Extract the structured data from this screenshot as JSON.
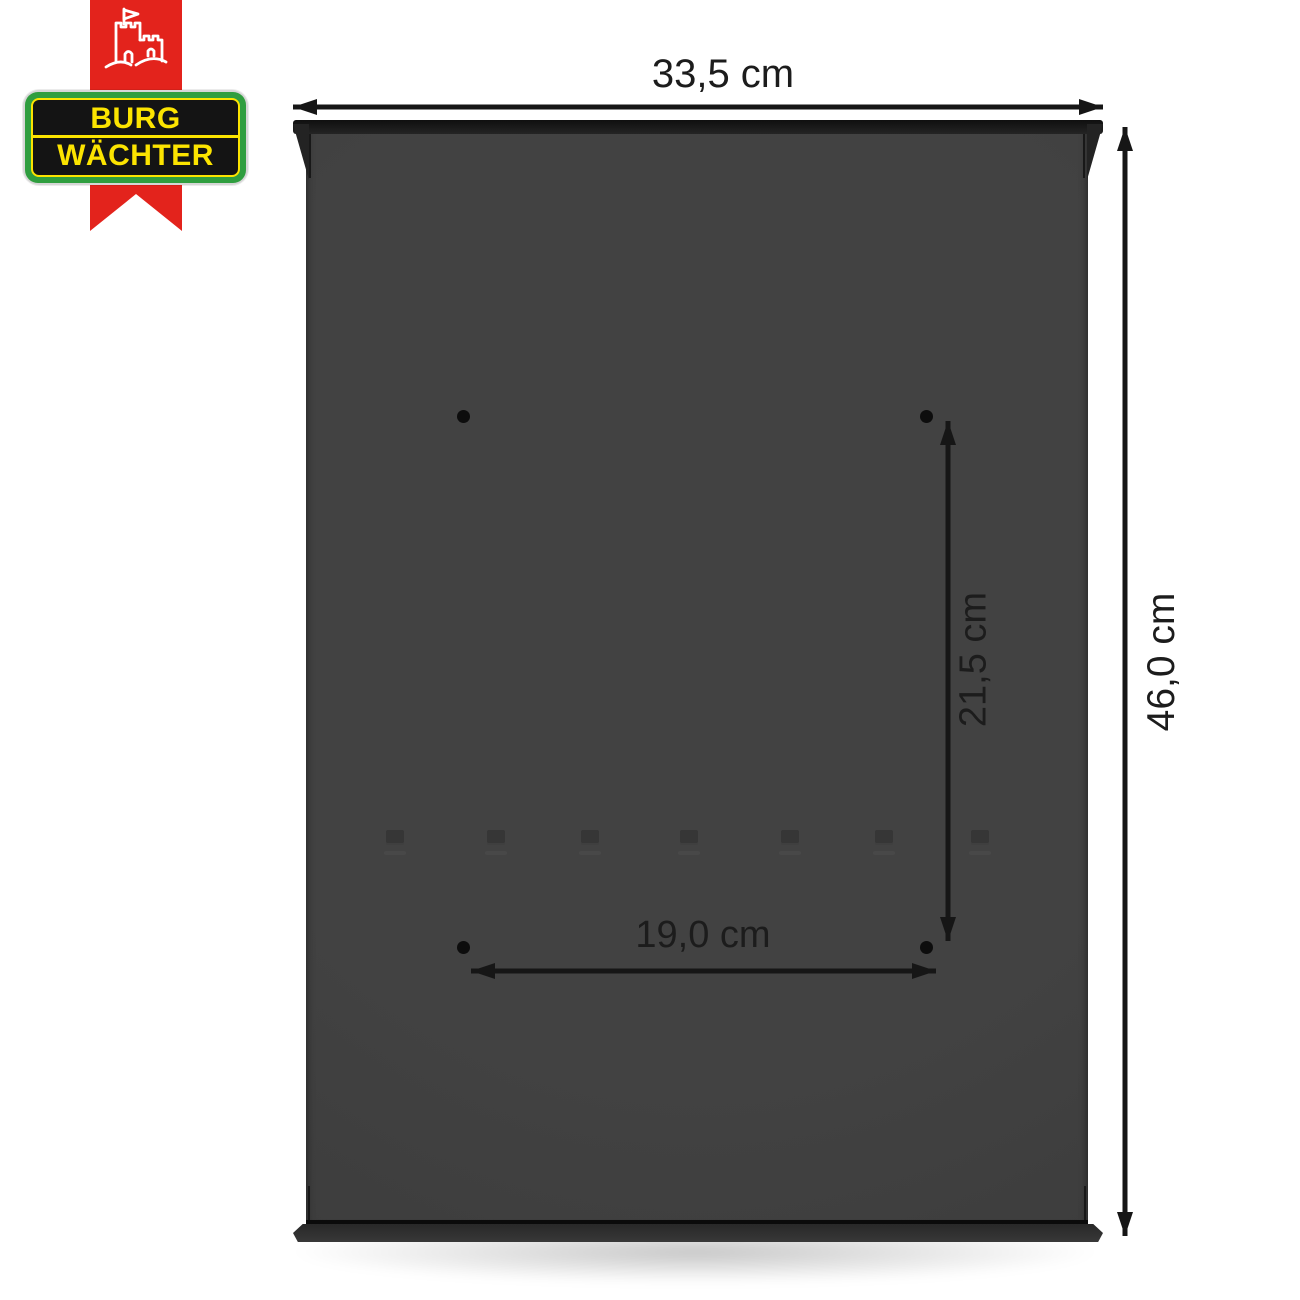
{
  "logo": {
    "brand_line1": "BURG",
    "brand_line2": "WÄCHTER",
    "castle_icon": "castle-with-flag",
    "colors": {
      "ribbon_red": "#e3231c",
      "badge_green": "#2f9e3f",
      "badge_yellow": "#fce400",
      "badge_black": "#141414",
      "badge_border": "#d6d6d6"
    }
  },
  "product": {
    "description": "mailbox back view with mounting holes",
    "body_color": "#3d3d3d",
    "mounting_holes_count": 4
  },
  "dimensions": {
    "width": {
      "label": "33,5 cm"
    },
    "height": {
      "label": "46,0 cm"
    },
    "hole_spacing_vertical": {
      "label": "21,5 cm"
    },
    "hole_spacing_horizontal": {
      "label": "19,0 cm"
    }
  }
}
